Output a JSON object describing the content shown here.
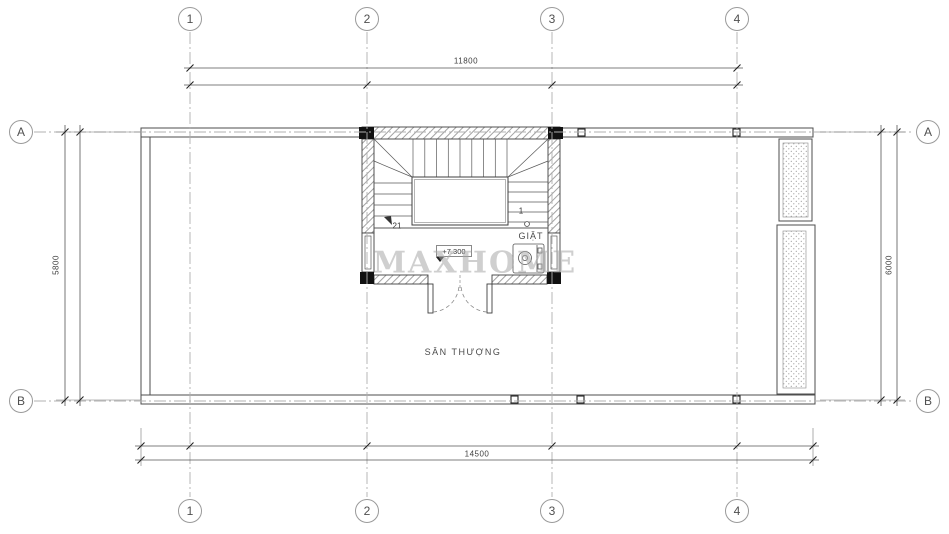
{
  "grid": {
    "columns": [
      "1",
      "2",
      "3",
      "4"
    ],
    "rows": [
      "A",
      "B"
    ]
  },
  "dimensions": {
    "top_overall": "11800",
    "bottom_overall": "14500",
    "left_overall": "5800",
    "right_overall": "6000"
  },
  "rooms": {
    "terrace": "SÂN THƯỢNG",
    "laundry": "GIẶT"
  },
  "annotations": {
    "level": "+7.300",
    "stair_last_step": "21",
    "stair_first_step": "1"
  },
  "watermark": "MAXHOME",
  "colors": {
    "line": "#4a4a4a",
    "grid_line": "#b0b0b0",
    "column_fill": "#111111",
    "watermark": "#a8a8a8",
    "background": "#ffffff"
  }
}
